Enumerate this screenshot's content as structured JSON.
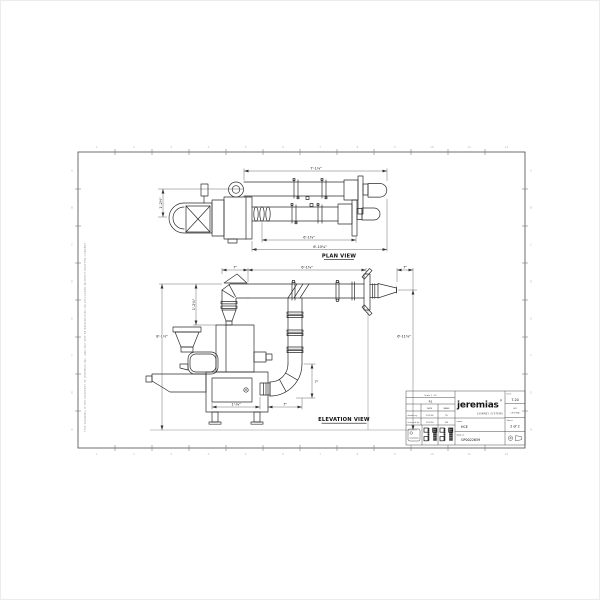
{
  "page": {
    "background": "#ffffff",
    "line_color": "#2b2b2b",
    "accent": "#1a1a1a"
  },
  "plan": {
    "label": "PLAN VIEW",
    "dim_top": "7'-1⅛\"",
    "dim_mid": "6'-1⅜\"",
    "dim_bottom": "6'-10¼\"",
    "dim_left": "1'-2½\""
  },
  "elevation": {
    "label": "ELEVATION VIEW",
    "dim_seven_a": "7\"",
    "dim_run": "6'-1⅜\"",
    "dim_seven_b": "7\"",
    "dim_offset": "1'-2¾\"",
    "dim_height": "8'-1½\"",
    "dim_outlet": "6'-11⅜\"",
    "dim_elbow": "7\"",
    "dim_bottom_a": "1'-⅛\"",
    "dim_bottom_b": "7\""
  },
  "title_block": {
    "scale_note": "Scale 1 : 15",
    "revision": "R1",
    "date_header": "DATE",
    "name_header": "NAME",
    "drawn_label": "drawn by",
    "drawn_date": "1/31/24",
    "drawn_name": "TR",
    "checked_label": "checked by",
    "checked_date": "1/31/24",
    "checked_name": "MS",
    "logo": "jeremias",
    "logo_reg": "®",
    "tagline": "CHIMNEY SYSTEMS",
    "item_label": "Item",
    "item": "7.20",
    "material_line1": "HD",
    "material_line2": "LECOMA",
    "sheet_label": "Sheet",
    "sheet": "2 of 2",
    "project_label": "name",
    "project": "HCE",
    "drawing_label": "dwg no.",
    "drawing_no": "GP0022659"
  },
  "margin": {
    "disclaimer": "THIS DRAWING IS THE PROPERTY OF JEREMIAS INC. AND MAY NOT BE REPRODUCED OR DISCLOSED WITHOUT WRITTEN CONSENT."
  },
  "zones": {
    "top": [
      "1",
      "2",
      "3",
      "4",
      "5",
      "6",
      "7",
      "8",
      "9",
      "10",
      "11",
      "12"
    ],
    "side": [
      "A",
      "B",
      "C",
      "D",
      "E",
      "F",
      "G",
      "H"
    ]
  }
}
